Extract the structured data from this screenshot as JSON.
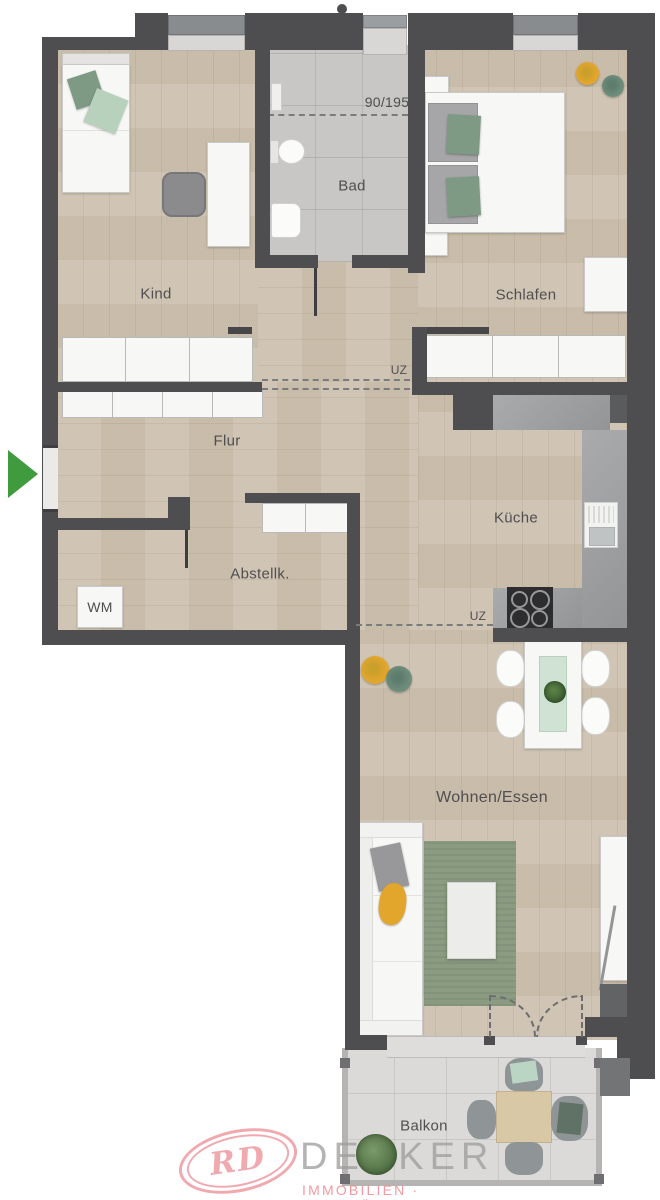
{
  "rooms": {
    "kind": {
      "label": "Kind"
    },
    "bad": {
      "label": "Bad"
    },
    "schlafen": {
      "label": "Schlafen"
    },
    "flur": {
      "label": "Flur"
    },
    "kueche": {
      "label": "Küche"
    },
    "abstell": {
      "label": "Abstellk."
    },
    "wohnen": {
      "label": "Wohnen/Essen"
    },
    "balkon": {
      "label": "Balkon"
    }
  },
  "annotations": {
    "door_size": "90/195",
    "beam_top": "UZ",
    "beam_bottom": "UZ",
    "washer": "WM"
  },
  "logo": {
    "monogram": "RD",
    "company": "DECKER",
    "tagline": "IMMOBILIEN · BAUTRÄGER"
  },
  "colors": {
    "wall": "#4e4e50",
    "wood": "#cdc1af",
    "bath_tile": "#c9c7c5",
    "balcony_tile": "#dbdad8",
    "counter": "#9fa1a3",
    "accent_green": "#3f9b3d",
    "furniture_white": "#f7f7f5",
    "pillow_green": "#7e9a85",
    "pillow_light_green": "#b7d1bd",
    "accent_yellow": "#e3a62c",
    "pouf_green": "#6d8c7c",
    "rug_green": "#8a9b82",
    "label_text": "#4f4f51",
    "logo_pink": "#efa3aa"
  }
}
